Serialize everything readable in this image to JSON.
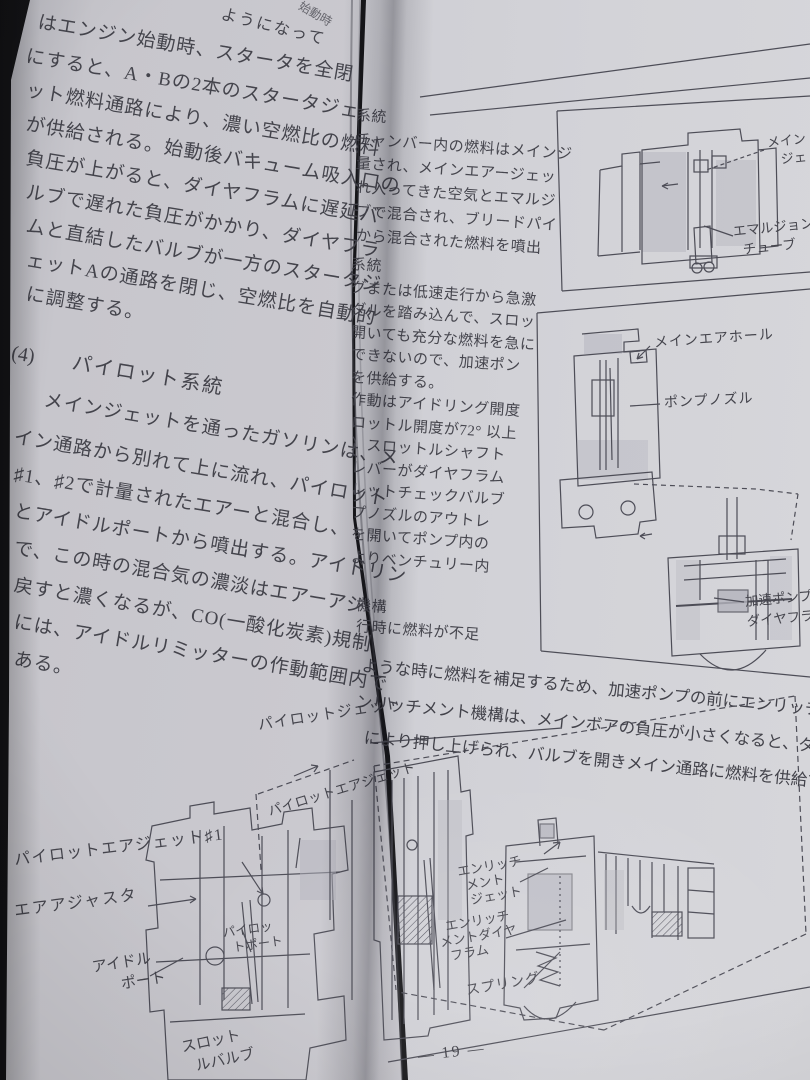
{
  "colors": {
    "paper_left": "#c7c6cc",
    "paper_right": "#d3d3d8",
    "ink": "#44444c",
    "line_art": "#4d4d57",
    "background": "#141417"
  },
  "left_page": {
    "fragments": {
      "top_right": "ようになって",
      "corner": "始動時"
    },
    "para1_lines": [
      "はエンジン始動時、スタータを全閉",
      "にすると、A・Bの2本のスタータジェ",
      "ット燃料通路により、濃い空燃比の燃料",
      "が供給される。始動後バキューム吸入口の",
      "負圧が上がると、ダイヤフラムに遅延バ",
      "ルブで遅れた負圧がかかり、ダイヤフラ",
      "ムと直結したバルブが一方のスタータジ",
      "ェットAの通路を閉じ、空燃比を自動的",
      "に調整する。"
    ],
    "section_heading": {
      "num": "(4)",
      "title": "パイロット系統"
    },
    "para2_lines": [
      "メインジェットを通ったガソリンは、メ",
      "イン通路から別れて上に流れ、パイロット",
      "♯1、♯2で計量されたエアーと混合し、",
      "とアイドルポートから噴出する。アイドリン",
      "で、この時の混合気の濃淡はエアーアジ",
      "戻すと濃くなるが、CO(一酸化炭素)規制",
      "には、アイドルリミッターの作動範囲内で",
      "ある。"
    ],
    "figure_labels": {
      "pilot_jet": "パイロットジェット",
      "pilot_air_jet2": "パイロットエアジェット",
      "pilot_air_jet1": "パイロットエアジェット♯1",
      "air_adjuster": "エアアジャスタ",
      "idle_port": [
        "アイドル",
        "ポート"
      ],
      "pilot_port": [
        "パイロッ",
        "トポート"
      ],
      "throttle_valve": [
        "スロット",
        "ルバルブ"
      ]
    }
  },
  "right_page": {
    "col_group1_lines": [
      "系統",
      "チャンバー内の燃料はメインジ",
      "量され、メインエアージェッ",
      "れ入ってきた空気とエマルジ",
      "ブで混合され、ブリードパイ",
      "から混合された燃料を噴出"
    ],
    "col_group2_lines": [
      "系統",
      "グまたは低速走行から急激",
      "ダルを踏み込んで、スロッ",
      "開いても充分な燃料を急に",
      "できないので、加速ポン",
      "を供給する。",
      "作動はアイドリング開度",
      "ロットル開度が72° 以上",
      "）スロットルシャフト",
      "レバーがダイヤフラム",
      "レットチェックバルブ",
      "プノズルのアウトレ",
      "を開いてポンプ内の",
      "よりベンチュリー内"
    ],
    "col_group3_lines": [
      "機構",
      "行時に燃料が不足"
    ],
    "full_lines": [
      "ような時に燃料を補足するため、加速ポンプの前にエンリッチメ",
      "ンリッチメント機構は、メインボアの負圧が小さくなると、ダイ",
      "により押し上げられ、バルブを開きメイン通路に燃料を供給す"
    ],
    "fig1_labels": {
      "main_jet": [
        "メイン",
        "ジェ"
      ],
      "emulsion_tube": [
        "エマルジョン",
        "チューブ"
      ]
    },
    "fig2_labels": {
      "main_air_hole": "メインエアホール",
      "pump_nozzle": "ポンプノズル",
      "accel_pump_diaphragm": [
        "加速ポンプ",
        "ダイヤフラ"
      ]
    },
    "fig3_labels": {
      "enrichment_jet": [
        "エンリッチ",
        "メント",
        "ジェット"
      ],
      "enrichment_diaphragm": [
        "エンリッチ",
        "メントダイヤ",
        "フラム"
      ],
      "spring": "スプリング"
    },
    "page_number": "— 19 —"
  }
}
